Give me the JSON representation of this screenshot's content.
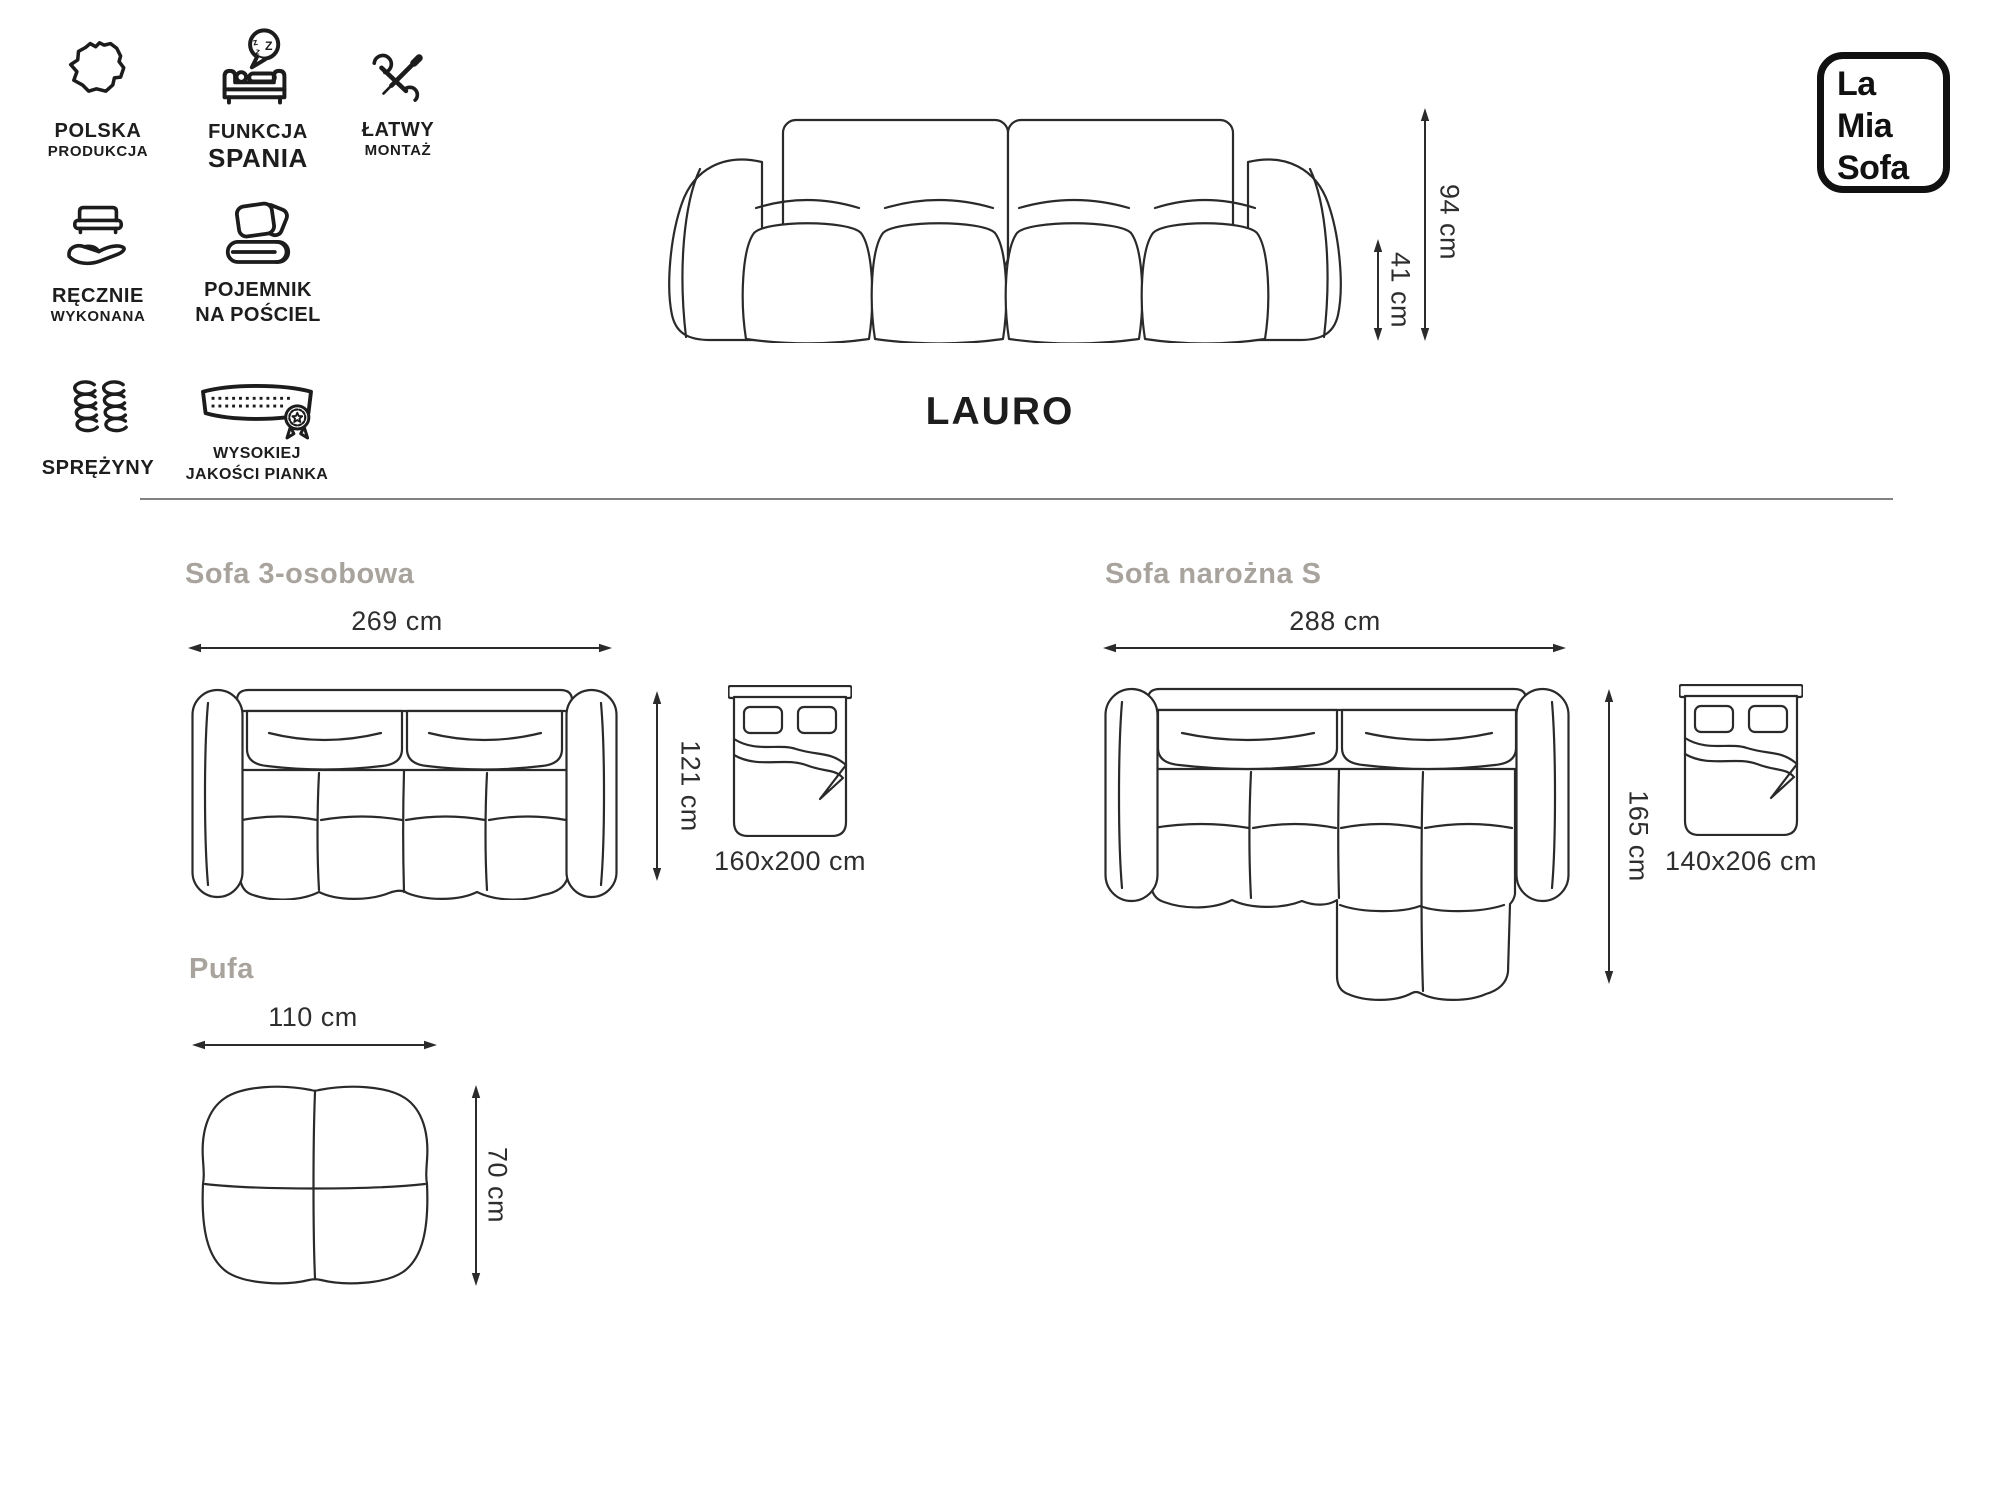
{
  "brand": {
    "name": "La Mia Sofa",
    "line1": "La",
    "line2": "Mia",
    "line3": "Sofa"
  },
  "product": {
    "title": "LAURO"
  },
  "badges": [
    {
      "id": "polska-produkcja",
      "line1": "POLSKA",
      "line2": "PRODUKCJA"
    },
    {
      "id": "funkcja-spania",
      "line1": "FUNKCJA",
      "line2": "SPANIA",
      "zzz": {
        "z1": "z",
        "z2": "Z",
        "z3": "z"
      }
    },
    {
      "id": "latwy-montaz",
      "line1": "ŁATWY",
      "line2": "MONTAŻ"
    },
    {
      "id": "recznie-wykonana",
      "line1": "RĘCZNIE",
      "line2": "WYKONANA"
    },
    {
      "id": "pojemnik-na-posciel",
      "line1": "POJEMNIK",
      "line2": "NA POŚCIEL"
    },
    {
      "id": "sprezyny",
      "line1": "SPRĘŻYNY"
    },
    {
      "id": "wysokiej-jakosci-pianka",
      "line1": "WYSOKIEJ",
      "line2": "JAKOŚCI PIANKA"
    }
  ],
  "front_view": {
    "height": "94 cm",
    "seat_height": "41 cm"
  },
  "variants": [
    {
      "name": "Sofa 3-osobowa",
      "width": "269 cm",
      "depth": "121 cm",
      "sleeping_area": "160x200 cm"
    },
    {
      "name": "Sofa narożna S",
      "width": "288 cm",
      "depth": "165 cm",
      "sleeping_area": "140x206 cm"
    },
    {
      "name": "Pufa",
      "width": "110 cm",
      "depth": "70 cm"
    }
  ],
  "colors": {
    "ink": "#1c1c1c",
    "line": "#2a2a2a",
    "heading_gray": "#a8a49d",
    "divider_gray": "#828282"
  }
}
